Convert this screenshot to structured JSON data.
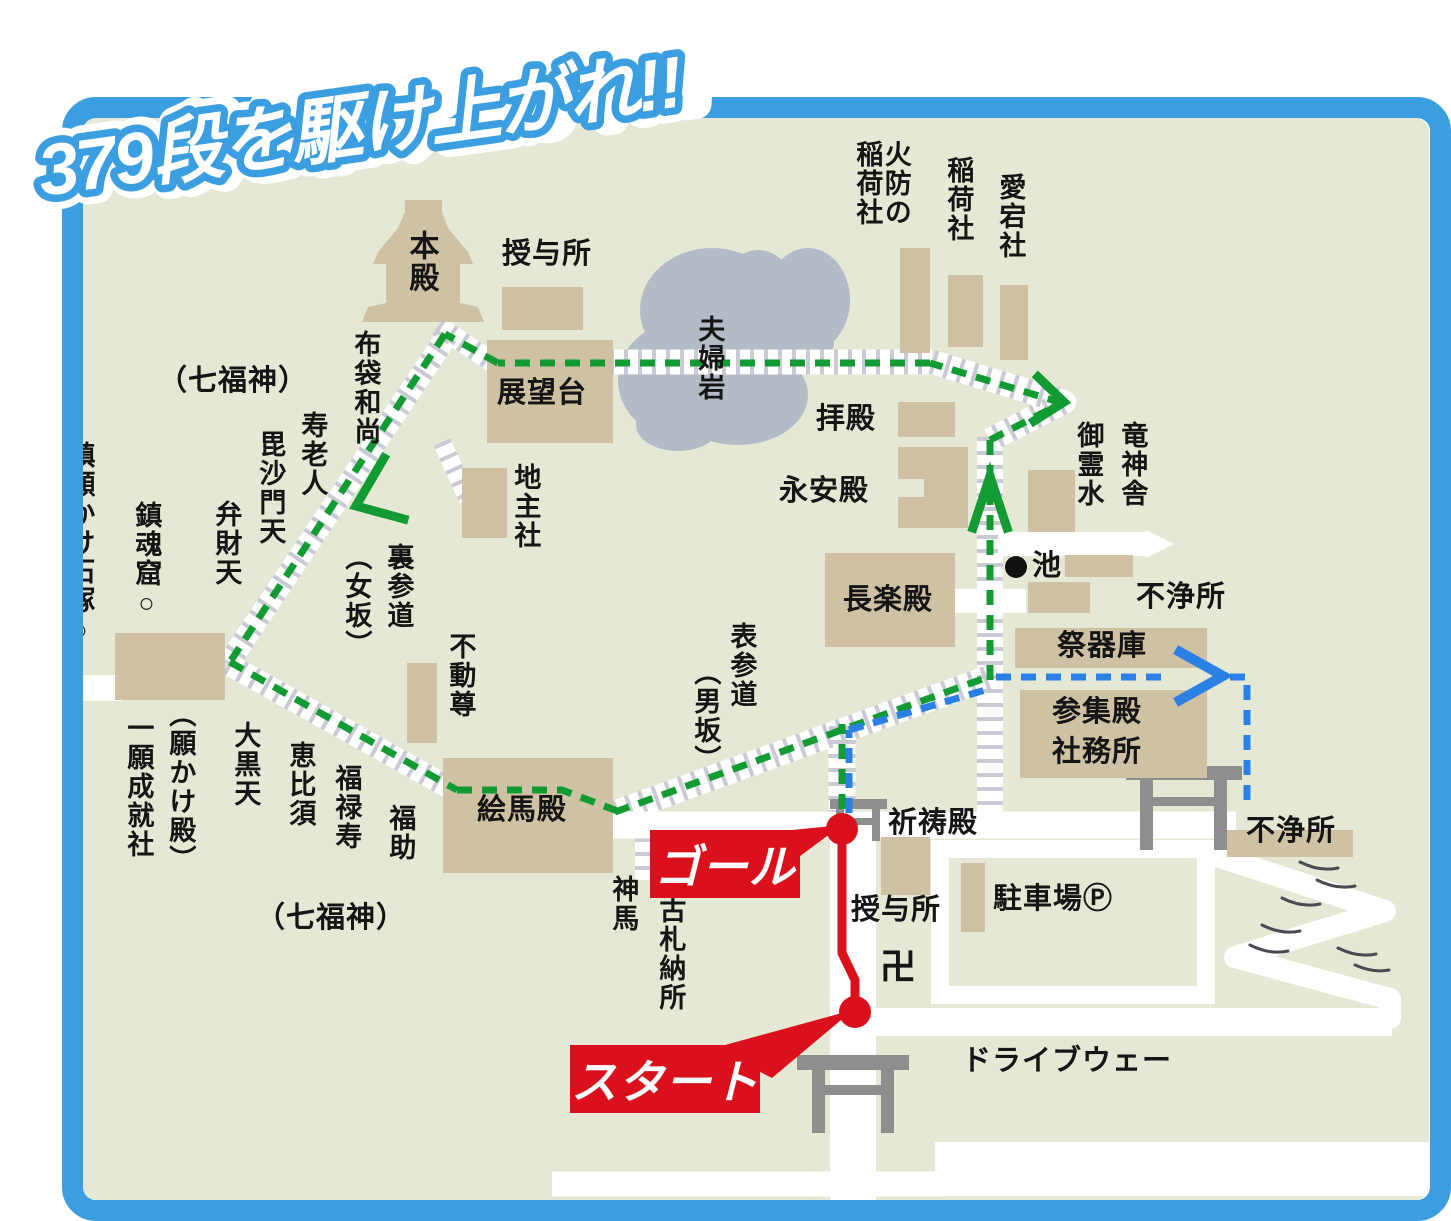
{
  "title": "379段を駆け上がれ!!",
  "badges": {
    "start": "スタート",
    "goal": "ゴール"
  },
  "labels": {
    "honden": "本殿",
    "juyosho_top": "授与所",
    "tenbodai": "展望台",
    "jishusha": "地主社",
    "meotoiwa": "夫婦岩",
    "hotei": "布袋和尚",
    "shichifukujin_top": "（七福神）",
    "jurojin": "寿老人",
    "bishamonten": "毘沙門天",
    "benzaiten": "弁財天",
    "chinkonkutsu": "鎮魂窟○",
    "chingan_ishizuka": "鎮願かけ石塚○",
    "uramairi": "裏参道",
    "onnazaka": "（女坂）",
    "fudoson": "不動尊",
    "gankakeden": "（願かけ殿）",
    "ichigan_joju": "一願成就社",
    "daikokuten": "大黒天",
    "ebisu": "恵比須",
    "fukurokuju": "福禄寿",
    "fukusuke": "福助",
    "shichifukujin_bottom": "（七福神）",
    "emaden": "絵馬殿",
    "shinme": "神馬",
    "kosatsu_nosho": "古札納所",
    "omotesando": "表参道",
    "otokozaka": "（男坂）",
    "haiden": "拝殿",
    "eianden": "永安殿",
    "chorakuden": "長楽殿",
    "hibuse_inari_1": "火防の",
    "hibuse_inari_2": "稲荷社",
    "inarisha": "稲荷社",
    "atagosha": "愛宕社",
    "ryujinsha": "竜神舎",
    "goreisui": "御霊水",
    "ike": "池",
    "fujosho_top": "不浄所",
    "saikiko": "祭器庫",
    "sanshuden": "参集殿",
    "shamusho": "社務所",
    "fujosho_right": "不浄所",
    "kitoden": "祈祷殿",
    "juyosho_bottom": "授与所",
    "manji": "卍",
    "parking": "駐車場Ⓟ",
    "driveway": "ドライブウェー"
  },
  "colors": {
    "frame_blue": "#3a9ee0",
    "map_background": "#e5e8d4",
    "building_tan": "#cfc1a3",
    "route_green": "#129a33",
    "route_blue": "#2b80e6",
    "route_red": "#da111c",
    "torii_gray": "#8e8e8e",
    "rock_gray": "#b3bbc7",
    "road_white": "#ffffff",
    "text_black": "#151515"
  }
}
